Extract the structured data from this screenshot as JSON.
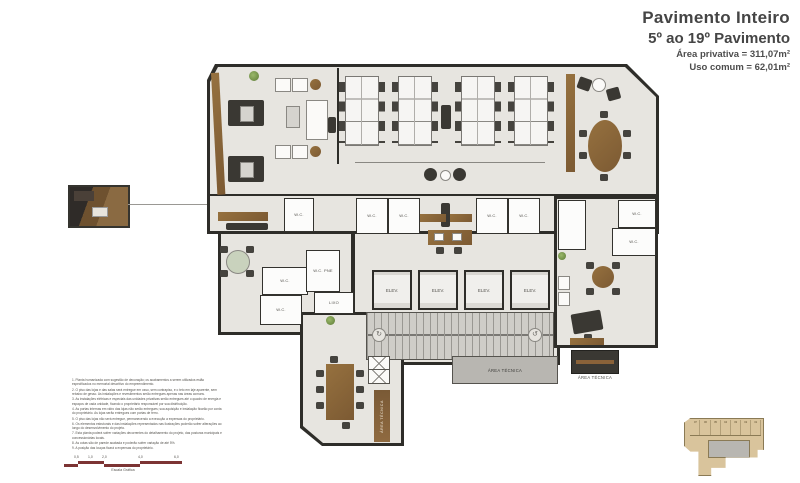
{
  "title_block": {
    "line1": "Pavimento Inteiro",
    "line2": "5º ao 19º Pavimento",
    "line3": "Área privativa = 311,07m²",
    "line4": "Uso comum = 62,01m²"
  },
  "plan": {
    "labels": {
      "elev": "ELEV.",
      "wc": "W.C.",
      "wc_pne": "W.C. PNE",
      "lixo": "LIXO",
      "area_tecnica": "ÁREA TÉCNICA"
    }
  },
  "disclaimer": {
    "items": [
      "1. Planta humanizada com sugestão de decoração; os acabamentos a serem utilizados estão especificados no memorial descritivo do empreendimento.",
      "2. O piso das lojas e das salas será entregue em osso, sem contrapiso, e o teto em laje aparente, sem rebaixo de gesso. As instalações e revestimentos serão entregues apenas nas áreas comuns.",
      "3. As instalações elétricas e especiais das unidades privativas serão entregues até o quadro de energia e espaços de cada unidade, ficando o proprietário responsável por sua distribuição.",
      "4. As portas internas em vidro das lojas não serão entregues; sua aquisição e instalação ficarão por conta do proprietário. As lojas serão entregues com portas de ferro.",
      "5. O piso das lojas não será entregue, permanecendo a execução a expensas do proprietário.",
      "6. Os elementos estruturais e das instalações representados nas ilustrações poderão sofrer alterações ao longo do desenvolvimento do projeto.",
      "7. Esta planta poderá sofrer variações decorrentes do detalhamento do projeto, das posturas municipais e concessionárias locais.",
      "8. As cotas são de parede acabada e poderão sofrer variação de até 5%.",
      "9. A posição das louças ficará a expensas do proprietário."
    ]
  },
  "scale_bar": {
    "ticks": [
      "0,5",
      "1,0",
      "2,0",
      "4,0",
      "6,0"
    ],
    "label": "Escala Gráfica",
    "color": "#7c3434"
  },
  "key_plan": {
    "units": [
      "07",
      "06",
      "05",
      "04",
      "03",
      "02",
      "01"
    ]
  },
  "colors": {
    "wall": "#2e2d29",
    "floor": "#e7e5e0",
    "wood": "#8a6239",
    "scale_red": "#7c3434",
    "keyplan_tan": "#d9c49c"
  }
}
